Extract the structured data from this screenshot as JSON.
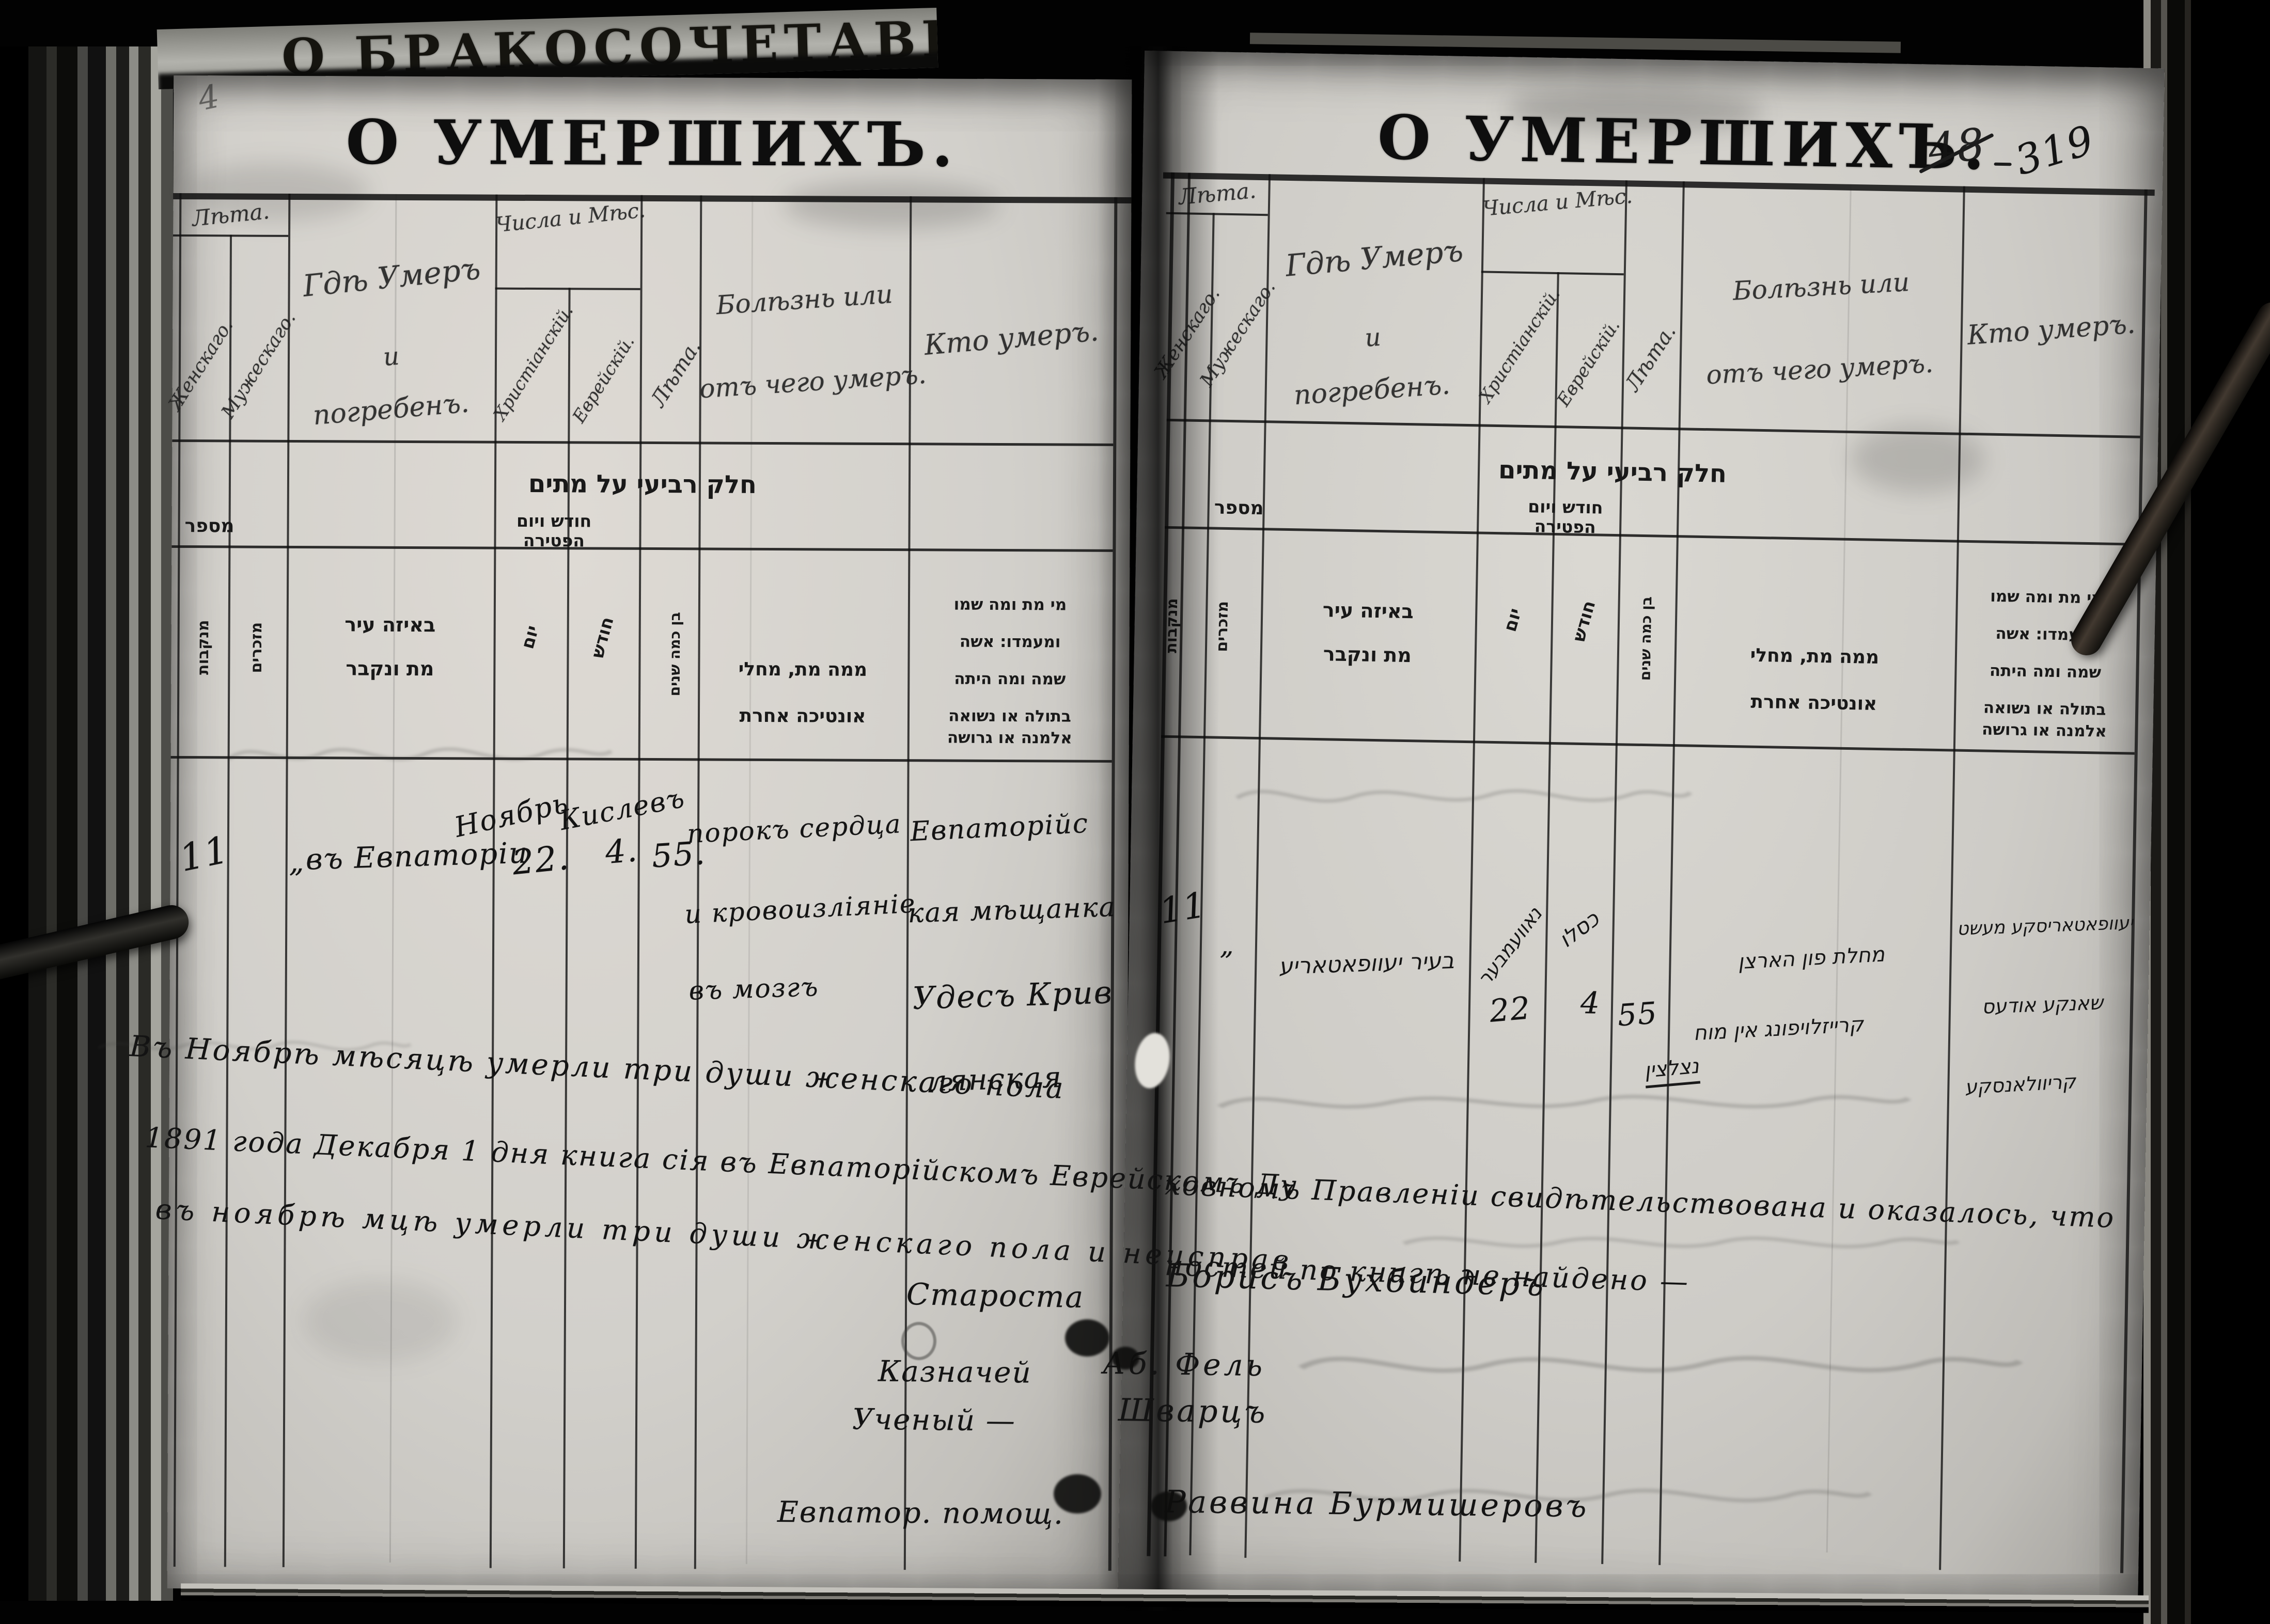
{
  "meta": {
    "previous_page_title": "О БРАКОСОЧЕТАВШ",
    "corner_mark": "4",
    "colors": {
      "paper": "#d6d4ce",
      "ink": "#141414",
      "background": "#000000"
    }
  },
  "titles": {
    "left": "О УМЕРШИХЪ.",
    "right": "О УМЕРШИХЪ.",
    "page_number_old": "48",
    "page_number": "319"
  },
  "ru": {
    "age_group": "Лѣта.",
    "female": "Женскаго.",
    "male": "Мужескаго.",
    "where_lines": [
      "Гдѣ Умеръ",
      "и",
      "погребенъ."
    ],
    "date_group": "Числа и Мѣс.",
    "christian": "Христіанскій.",
    "jewish": "Еврейскій.",
    "age_col": "Лѣта.",
    "cause_lines": [
      "Болѣзнь или",
      "отъ чего умеръ."
    ],
    "who": "Кто умеръ."
  },
  "he": {
    "section": "חלק רביעי על מתים",
    "number": "מספר",
    "females": "מנקבות",
    "males": "מזכרים",
    "where_lines": [
      "באיזה עיר",
      "מת ונקבר"
    ],
    "date_group_lines": [
      "חודש ויום",
      "הפטירה"
    ],
    "day": "יום",
    "month": "חודש",
    "age": "בן כמה שנים",
    "cause_lines": [
      "ממה מת, מחלי",
      "אונטיכה אחרת"
    ],
    "who_lines": [
      "מי מת ומה שמו",
      "ומעמדו: אשה",
      "שמה ומה היתה",
      "בתולה או נשואה",
      "אלמנה או גרושה"
    ]
  },
  "left_entry": {
    "number": "11",
    "ditto": "„",
    "where": "въ Евпаторіи",
    "month_christian": "Ноябрь",
    "day_christian": "22.",
    "month_jewish": "Кислевъ",
    "day_jewish": "4.",
    "age": "55.",
    "cause_lines": [
      "порокъ сердца",
      "и кровоизліяніе",
      "въ мозгъ"
    ],
    "who_lines": [
      "Евпаторійс",
      "кая мѣщанка",
      "Удесъ Крив",
      "лянская"
    ]
  },
  "right_entry": {
    "number": "11",
    "ditto": "„",
    "where": "בעיר יעוופאטאריע",
    "month_civil": "נאוועמבער",
    "day_civil": "22",
    "month_jewish": "כסלו",
    "day_jewish": "4",
    "age": "55",
    "cause_lines": [
      "מחלת פון הארצן",
      "קרייזלויפונג אין מוח",
      "נצלצין"
    ],
    "who_lines": [
      "יעוופאטאריסקע מעשט",
      "שאנקע אודעס",
      "קריוולאנסקע"
    ]
  },
  "footer": {
    "november_note": "Въ Ноябрѣ мѣсяцѣ умерли три души женскаго пола",
    "att1_left": "1891 года Декабря 1 дня книга сія въ Евпаторійскомъ Еврейскомъ Ду",
    "att1_right": "ховномъ Правленіи свидѣтельствована и оказалось, что",
    "att2_left": "въ ноябрѣ мцѣ умерли три души женскаго пола и неисправ",
    "att2_right": "ностей по книгѣ не найдено —",
    "starosta_label": "Староста",
    "starosta_name": "Борисъ Бухбиндеръ",
    "treasurer_label": "Казначей",
    "treasurer_name": "Аб. Фель",
    "scholar_label": "Ученый —",
    "scholar_name": "Шварцъ",
    "rabbi_label": "Евпатор. помощ.",
    "rabbi_name": "Раввина Бурмишеровъ"
  }
}
